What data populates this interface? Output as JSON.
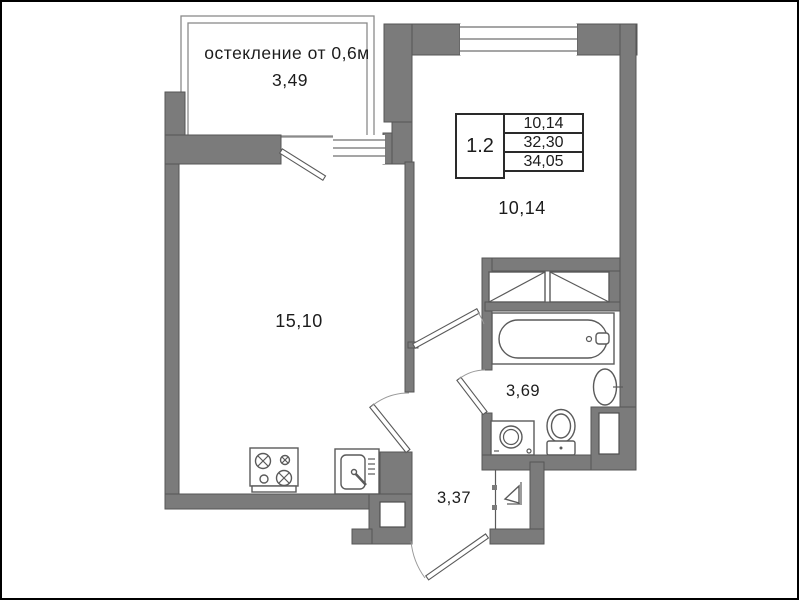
{
  "colors": {
    "wall_fill": "#7b7b7b",
    "wall_stroke": "#565656",
    "line": "#8a8a8a",
    "text": "#1c1c1c",
    "background": "#ffffff"
  },
  "unit_card": {
    "unit": "1.2",
    "values": [
      "10,14",
      "32,30",
      "34,05"
    ]
  },
  "balcony": {
    "note": "остекление от 0,6м",
    "area": "3,49"
  },
  "rooms": {
    "living_kitchen": {
      "label": "15,10"
    },
    "bedroom": {
      "label": "10,14"
    },
    "bathroom": {
      "label": "3,69"
    },
    "hall": {
      "label": "3,37"
    }
  },
  "fixtures": [
    "bathtub",
    "washbasin",
    "toilet",
    "washing-machine",
    "wardrobe",
    "stove",
    "kitchen-sink",
    "entrance-arrow",
    "ventilation-shaft-hall",
    "ventilation-shaft-bathroom",
    "balcony-door",
    "bedroom-door",
    "bathroom-door",
    "kitchen-door",
    "entrance-door",
    "window-balcony",
    "window-bedroom"
  ]
}
